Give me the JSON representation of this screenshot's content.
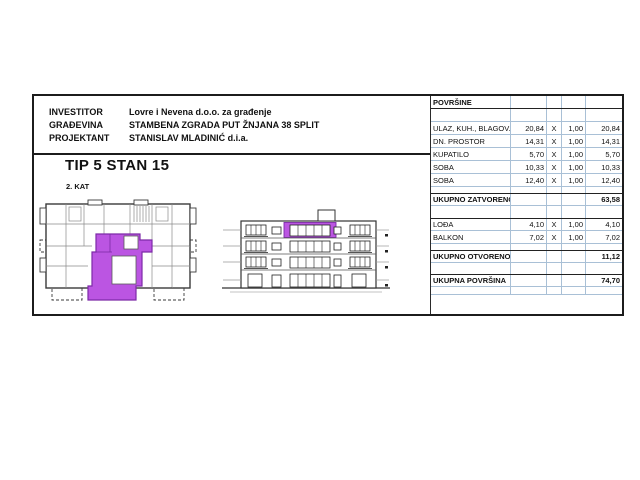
{
  "project_info": {
    "rows": [
      {
        "label": "INVESTITOR",
        "value": "Lovre i Nevena d.o.o. za građenje"
      },
      {
        "label": "GRAĐEVINA",
        "value": "STAMBENA ZGRADA PUT ŽNJANA 38 SPLIT"
      },
      {
        "label": "PROJEKTANT",
        "value": "STANISLAV MLADINIĆ d.i.a."
      }
    ]
  },
  "apartment": {
    "title": "TIP 5 STAN 15",
    "floor": "2. KAT"
  },
  "areas_table": {
    "title": "POVRŠINE",
    "multiply_sign": "X",
    "closed_items": [
      {
        "label": "ULAZ, KUH., BLAGOV.",
        "area": "20,84",
        "factor": "1,00",
        "total": "20,84"
      },
      {
        "label": "DN. PROSTOR",
        "area": "14,31",
        "factor": "1,00",
        "total": "14,31"
      },
      {
        "label": "KUPATILO",
        "area": "5,70",
        "factor": "1,00",
        "total": "5,70"
      },
      {
        "label": "SOBA",
        "area": "10,33",
        "factor": "1,00",
        "total": "10,33"
      },
      {
        "label": "SOBA",
        "area": "12,40",
        "factor": "1,00",
        "total": "12,40"
      }
    ],
    "total_closed": {
      "label": "UKUPNO ZATVORENO",
      "total": "63,58"
    },
    "open_items": [
      {
        "label": "LOĐA",
        "area": "4,10",
        "factor": "1,00",
        "total": "4,10"
      },
      {
        "label": "BALKON",
        "area": "7,02",
        "factor": "1,00",
        "total": "7,02"
      }
    ],
    "total_open": {
      "label": "UKUPNO OTVORENO",
      "total": "11,12"
    },
    "total_all": {
      "label": "UKUPNA POVRŠINA",
      "total": "74,70"
    }
  },
  "colors": {
    "apartment_highlight": "#bb55e2",
    "apartment_outline": "#7d2aa8",
    "table_grid": "#a9c0d6"
  }
}
